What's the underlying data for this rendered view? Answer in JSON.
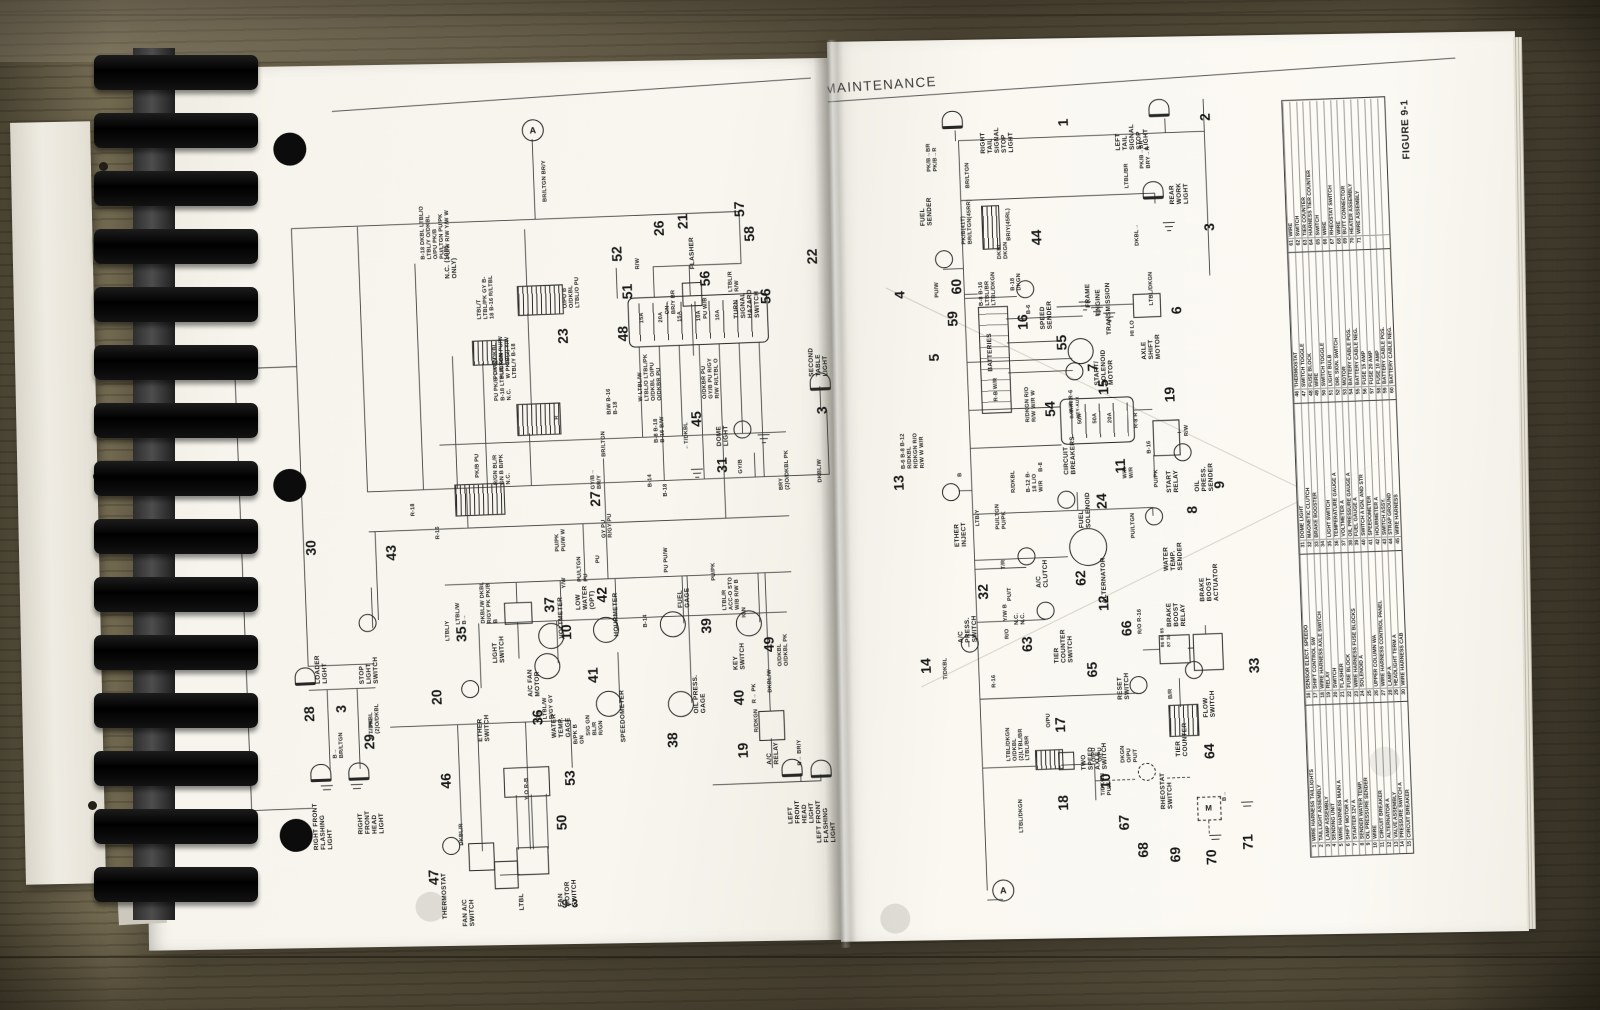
{
  "colors": {
    "paper": "#f8f6ef",
    "wood": "#6a6149",
    "ink": "#1d1d1d",
    "binding": "#0c0c0c"
  },
  "page": {
    "header": "MAINTENANCE",
    "number": "9-3",
    "figure": "FIGURE 9-1",
    "connector_top": "A",
    "connector_bottom": "A"
  },
  "left": {
    "c": {
      "n3a": "3",
      "n3b": "3",
      "n10": "10",
      "n19": "19",
      "n20": "20",
      "n21": "21",
      "n22": "22",
      "n23": "23",
      "n26": "26",
      "n27": "27",
      "n28": "28",
      "n29": "29",
      "n30": "30",
      "n31": "31",
      "n35": "35",
      "n36": "36",
      "n37": "37",
      "n38": "38",
      "n39": "39",
      "n40": "40",
      "n41": "41",
      "n42": "42",
      "n43": "43",
      "n45": "45",
      "n46": "46",
      "n47": "47",
      "n48": "48",
      "n49": "49",
      "n50": "50",
      "n51": "51",
      "n52": "52",
      "n53": "53",
      "n56a": "56",
      "n56b": "56",
      "n57": "57",
      "n58": "58"
    },
    "comp": {
      "rff": "RIGHT FRONT FLASHING LIGHT",
      "rfh": "RIGHT FRONT HEAD LIGHT",
      "loader": "LOADER LIGHT",
      "thermostat": "THERMOSTAT",
      "fan_ac": "FAN A/C SWITCH",
      "ac_fan": "A/C FAN MOTOR",
      "fan_sw": "FAN MOTOR SWITCH",
      "ether": "ETHER SWITCH",
      "stop": "STOP LIGHT SWITCH",
      "light_sw": "LIGHT SWITCH",
      "wtg": "WATER TEMP. GAGE",
      "volt": "VOLTMETER",
      "low_water": "LOW WATER (OPT)",
      "hour": "HOURMETER",
      "speedo": "SPEEDOMETER",
      "oil": "OIL PRESS. GAGE",
      "fuel": "FUEL GAGE",
      "key": "KEY SWITCH",
      "acrelay": "A/C RELAY",
      "dome": "DOME LIGHT",
      "second": "SECOND TABLE LIGHT",
      "hazard": "TURN SIGNAL HAZARD SWITCH",
      "flasher": "FLASHER",
      "nc1085": "N.C. (1085 ONLY)",
      "lfh": "LEFT FRONT HEAD LIGHT",
      "lff": "LEFT FRONT FLASHING LIGHT",
      "ltbl_box": "LTBL"
    },
    "w": {
      "w1": "B-18 DKBL LTBL/O LTBL/Y O/DKBL O/PU PK/B PU/LTGN PU/PK PU/W R/W Y/W W",
      "w2": "BR/LTGN BR/Y",
      "w3": "LTBL/T LTBL/PK GY B-18 B-16 R/LTBL",
      "w4": "PU/PK DKBL PU/LTGN PU/W W PK/B(2) Y/W LTBL/Y B-18",
      "w5": "O/PU B O/DKBL LTBL/O PU",
      "w6": "PK/B PU",
      "w7": "GN→ BR/Y BR",
      "w8": "R/W",
      "w9": "PU W/B",
      "w10": "15A 20A 15A 10A 10A",
      "w11": "W LTBL/W LTBL/O LTBL/PK O/DKBL O/PU O/DKBR PU",
      "w12": "O/DKBR PU GY/B PU R/GY R/W R/LTBL O",
      "w13": "LTBL/R R/W",
      "w14": "B/W B-16 B-18",
      "w15": "PU PK/B DKGN B-18 LTBL/DKGN N.C.",
      "w16": "R/GN BL/R GN B B/PK N.C.",
      "w17": "←T/DKBL",
      "w18": "R-16",
      "w19": "R-18",
      "w20": "R",
      "w21": "GY/B→ BR/Y",
      "w22": "BR/LTGN",
      "w23": "B-8 B-18 B-16 B/W",
      "w24": "B-14",
      "w25": "B-18",
      "w26": "GY PU R/GY PU",
      "w27": "PU/PK PU/W W",
      "w28": "DKBL/W DKBL R/GY PK PK/B B",
      "w29": "LTBL/Y",
      "w30": "LTBL/W B→",
      "w31": "GY LTBL/W R/GY GY",
      "w32": "Y/W",
      "w33": "PU/LTGN PU",
      "w34": "SIG GN BL/R R/GN",
      "w35": "B/PK B GN",
      "w36": "PU",
      "w37": "B-14",
      "w38": "PU PU/W",
      "w39": "PU/PK",
      "w40": "LTBL/R ACC-O STO W/B R/W B",
      "w41": "IGN",
      "w42": "R/DKGN",
      "w43": "O/DKBL O/DKBL PK",
      "w44": "B→ BR/LTGN",
      "w45": "R→ PK",
      "w46": "DKBL/R",
      "w47": "T/DKBL (2)O/DKBL",
      "w49": "Y O R-B",
      "w50": "GY/B",
      "w51": "BRY (2)O/DKBL PK",
      "w52": "DKBL/W",
      "w53": "DKBL/W",
      "w54": "B→ BR/Y",
      "w55": "R→ PK"
    }
  },
  "right": {
    "c": {
      "n1": "1",
      "n2": "2",
      "n3": "3",
      "n4": "4",
      "n5": "5",
      "n6": "6",
      "n7": "7",
      "n8": "8",
      "n9": "9",
      "n10": "10",
      "n11": "11",
      "n12": "12",
      "n13": "13",
      "n14": "14",
      "n15": "15",
      "n16": "16",
      "n17": "17",
      "n18": "18",
      "n19": "19",
      "n24": "24",
      "n32": "32",
      "n33": "33",
      "n44": "44",
      "n54": "54",
      "n55": "55",
      "n59": "59",
      "n60": "60",
      "n62": "62",
      "n63": "63",
      "n64": "64",
      "n65": "65",
      "n66": "66",
      "n67": "67",
      "n68": "68",
      "n69": "69",
      "n70": "70",
      "n71": "71"
    },
    "comp": {
      "rt": "RIGHT TAIL SIGNAL STOP LIGHT",
      "lt": "LEFT TAIL SIGNAL STOP LIGHT",
      "rw": "REAR WORK LIGHT",
      "fs": "FUEL SENDER",
      "bat": "BATTERIES",
      "ss": "SPEED SENDER",
      "frame": "FRAME",
      "engine": "ENGINE",
      "trans": "TRANSMISSION",
      "asm": "AXLE SHIFT MOTOR",
      "hilo": "HI LO",
      "ssm": "START/ SOLENOID MOTOR",
      "cb": "CIRCUIT BREAKERS",
      "sr": "START RELAY",
      "ops": "OIL PRESS. SENDER",
      "wts": "WATER TEMP. SENDER",
      "ei": "ETHER INJECT",
      "fsol": "FUEL SOLENOID",
      "acc": "A/C CLUTCH",
      "alt": "ALTERNATOR",
      "tcs": "TIER COUNTER SWITCH",
      "aps": "A/C PRESS. SWITCH",
      "rsw": "RESET SWITCH",
      "bbr": "BRAKE BOOST RELAY",
      "bba": "BRAKE BOOST ACTUATOR",
      "fsw": "FLOW SWITCH",
      "tc": "TIER COUNTER",
      "tsas": "TWO SPEED AXLE SWITCH",
      "rh": "RHEOSTAT SWITCH",
      "m": "M"
    },
    "w": {
      "v1": "PK/B→BR PK/B→R",
      "v2": "BR/LTGN",
      "v3": "PK/B→BR BRY→R",
      "v4": "DKBL→",
      "v5": "LTBL/BR",
      "v6": "PK/B(41T) BR/LTGN(45RR)",
      "v7": "BR/Y(45RL)",
      "v8": "DKBL DKGN",
      "v9": "PU/W",
      "v10": "B-8 B-16 LTBL/BR LTBL/DKGN",
      "v11": "B-18 DKGN",
      "v12": "B-6",
      "v13": "LTBL/DKGN",
      "v14": "W/R R-6",
      "v15": "R-B W/R",
      "v16": "R/DKGN R/O R/W W/R W",
      "v17": "50A 50A 20A",
      "v18": "BAT-AUX KEY-AUX",
      "v19": "R-8 R",
      "v20": "B-16",
      "v21": "W/R W/R",
      "v22": "R/W",
      "v23": "PU/PK",
      "v24": "PU/LTGN",
      "v25": "B-6 B-8 B-12 R/DKBL R/DKGN R/O R/W W W/R",
      "v26": "PU/LTGN PU/PK",
      "v27": "R/DKBL",
      "v28": "B-12 B-18 L/O W/R",
      "v29": "B-8",
      "v30": "LTB/Y",
      "v31": "B",
      "v32": "T/R",
      "v33": "PU/T",
      "v34": "Y/W B",
      "v35": "N.C. N.C.",
      "v36": "T/DKBL",
      "v37": "R-16",
      "v38": "R/O",
      "v39": "86 88 85 87 30",
      "v40": "R/O R-16",
      "v41": "B/R",
      "v42": "LTBL/DKGN O/DKBL (2)LTBL/BR LTBL/BR",
      "v43": "LTBL/DKGN",
      "v44": "O/PU O/PU",
      "v45": "T/DKGN PU/T",
      "v46": "DKGN O/PU PU/T",
      "v47": "B→",
      "v48": "O/PU"
    }
  },
  "legend": {
    "groups": [
      [
        {
          "n": "1",
          "t": "WIRE HARNESS TAILLIGHTS"
        },
        {
          "n": "2",
          "t": "TAILLIGHT ASSEMBLY"
        },
        {
          "n": "3",
          "t": "LAMP ASSEMBLY"
        },
        {
          "n": "4",
          "t": "SENDING UNIT"
        },
        {
          "n": "5",
          "t": "WIRE HARNESS MAIN A"
        },
        {
          "n": "6",
          "t": "SHIFT MOTOR A"
        },
        {
          "n": "7",
          "t": "STARTER 12V A"
        },
        {
          "n": "8",
          "t": "SENDER WATER TEMP."
        },
        {
          "n": "9",
          "t": "OIL PRESSURE SENDER"
        },
        {
          "n": "10",
          "t": "WIRE"
        },
        {
          "n": "11",
          "t": "CIRCUIT BREAKER"
        },
        {
          "n": "12",
          "t": "ALTERNATOR A"
        },
        {
          "n": "13",
          "t": "VALVE ASSEMBLY"
        },
        {
          "n": "14",
          "t": "PRESSURE SWITCH A"
        },
        {
          "n": "15",
          "t": "CIRCUIT BREAKER"
        }
      ],
      [
        {
          "n": "16",
          "t": "SENSOR ELECT. SPEEDO"
        },
        {
          "n": "17",
          "t": "SHIFT CONTROL SW"
        },
        {
          "n": "18",
          "t": "WIRE HARNESS AXLE SWITCH"
        },
        {
          "n": "19",
          "t": "RELAY"
        },
        {
          "n": "20",
          "t": "SWITCH"
        },
        {
          "n": "21",
          "t": "FLASHER"
        },
        {
          "n": "22",
          "t": "FUSE BLOCK"
        },
        {
          "n": "23",
          "t": "WIRE HARNESS FUSE BLOCKS"
        },
        {
          "n": "24",
          "t": "SOLENOID A"
        },
        {
          "n": "25",
          "t": ""
        },
        {
          "n": "26",
          "t": "UPPER COLUMN WA"
        },
        {
          "n": "27",
          "t": "WIRE HARNESS CONTROL PANEL"
        },
        {
          "n": "28",
          "t": "LAMP A"
        },
        {
          "n": "29",
          "t": "HEADLIGHT TERM A"
        },
        {
          "n": "30",
          "t": "WIRE HARNESS CAB"
        }
      ],
      [
        {
          "n": "31",
          "t": "DOME LIGHT"
        },
        {
          "n": "32",
          "t": "MAGNETIC CLUTCH"
        },
        {
          "n": "33",
          "t": "BRAKE BOOSTER"
        },
        {
          "n": "34",
          "t": ""
        },
        {
          "n": "35",
          "t": "LIGHT SWITCH"
        },
        {
          "n": "36",
          "t": "TEMPERATURE GAUGE A"
        },
        {
          "n": "37",
          "t": "VOLTMETER A"
        },
        {
          "n": "38",
          "t": "OIL PRESSURE GAUGE A"
        },
        {
          "n": "39",
          "t": "FUEL GAUGE A"
        },
        {
          "n": "40",
          "t": "SWITCH A IGN. AND STR"
        },
        {
          "n": "41",
          "t": "SPEEDOMETER"
        },
        {
          "n": "42",
          "t": "HOURMETER A"
        },
        {
          "n": "43",
          "t": "SWITCH ASSY."
        },
        {
          "n": "44",
          "t": "STRAP GROUND"
        },
        {
          "n": "45",
          "t": "WIRE HARNESS"
        }
      ],
      [
        {
          "n": "46",
          "t": "THERMOSTAT"
        },
        {
          "n": "47",
          "t": "SWITCH TOGGLE"
        },
        {
          "n": "48",
          "t": "FUSE BLOCK"
        },
        {
          "n": "49",
          "t": "WIRE"
        },
        {
          "n": "50",
          "t": "SWITCH TOGGLE"
        },
        {
          "n": "51",
          "t": "LIGHT BULB"
        },
        {
          "n": "52",
          "t": "DIR. SIGN. SWITCH"
        },
        {
          "n": "53",
          "t": "MOTOR"
        },
        {
          "n": "54",
          "t": "BATTERY CABLE POS."
        },
        {
          "n": "55",
          "t": "BATTERY CABLE NEG."
        },
        {
          "n": "56",
          "t": "FUSE 15 AMP"
        },
        {
          "n": "57",
          "t": "FUSE 20 AMP"
        },
        {
          "n": "58",
          "t": "FUSE 10 AMP"
        },
        {
          "n": "59",
          "t": "BATTERY CABLE POS."
        },
        {
          "n": "60",
          "t": "BATTERY CABLE NEG."
        }
      ],
      [
        {
          "n": "61",
          "t": "WIRE"
        },
        {
          "n": "62",
          "t": "SWITCH"
        },
        {
          "n": "63",
          "t": "TIER COUNTER"
        },
        {
          "n": "64",
          "t": "HARNESS TIER COUNTER"
        },
        {
          "n": "65",
          "t": "SWITCH"
        },
        {
          "n": "66",
          "t": "WIRE"
        },
        {
          "n": "67",
          "t": "RHEOSTAT SWITCH"
        },
        {
          "n": "68",
          "t": "WIRE"
        },
        {
          "n": "69",
          "t": "BUTT CONNECTOR"
        },
        {
          "n": "70",
          "t": "HEATER ASSEMBLY"
        },
        {
          "n": "71",
          "t": "WIRE ASSEMBLY"
        },
        {
          "n": "",
          "t": ""
        },
        {
          "n": "",
          "t": ""
        },
        {
          "n": "",
          "t": ""
        },
        {
          "n": "",
          "t": ""
        }
      ]
    ]
  }
}
